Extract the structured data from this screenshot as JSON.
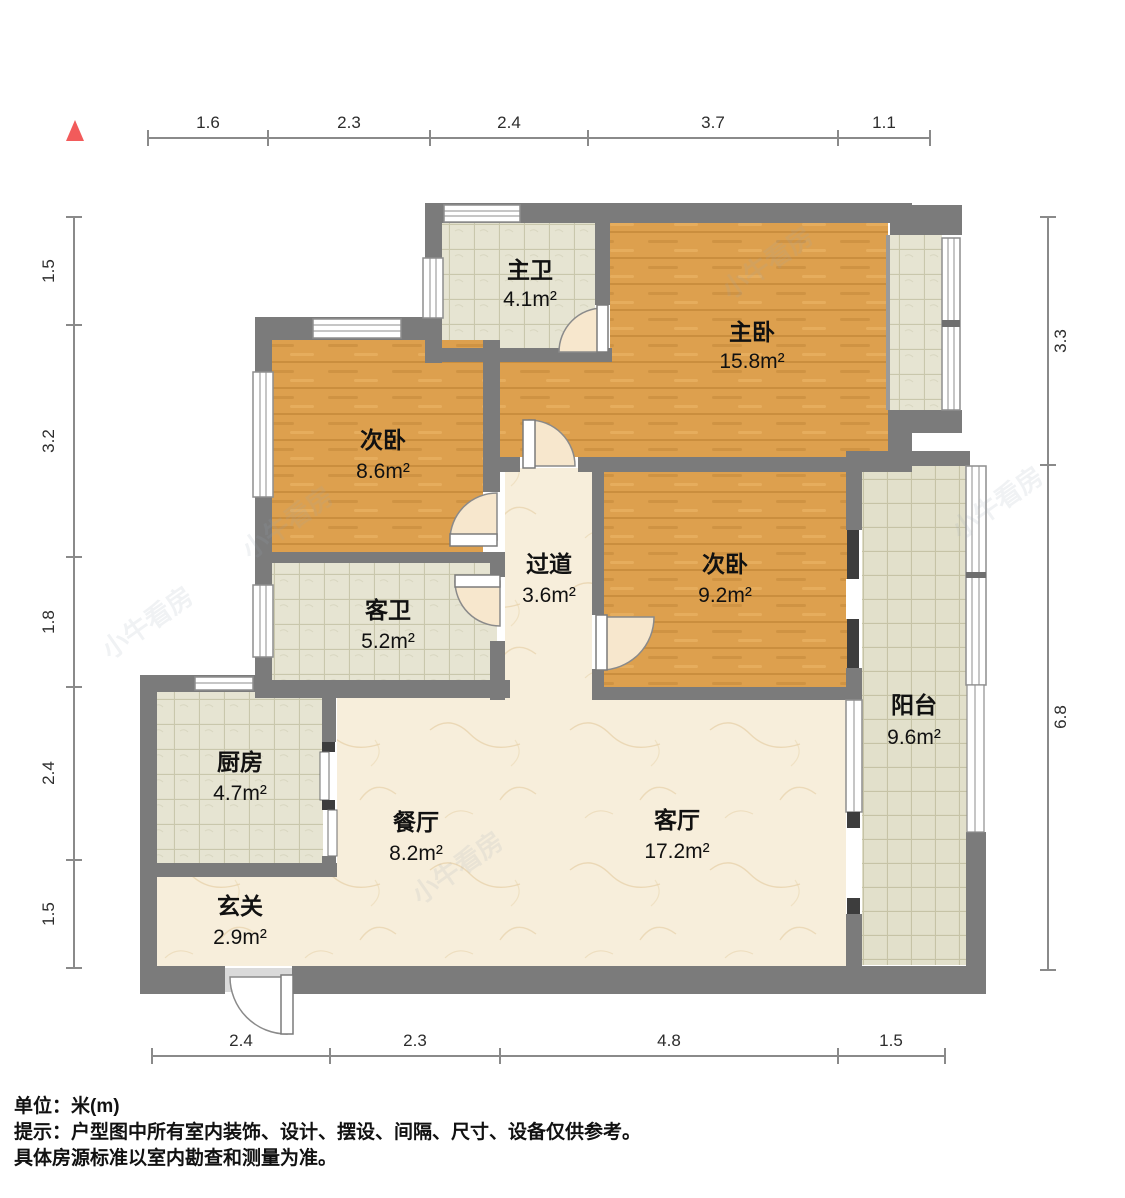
{
  "meta": {
    "type": "floor-plan",
    "watermark": "小牛看房"
  },
  "compass": {
    "shape": "triangle",
    "color": "#f25b5b",
    "meaning": "north-indicator"
  },
  "colors": {
    "wall": "#7b7b7b",
    "wood_floor": "#dda04e",
    "tile_floor": "#e6e4d2",
    "marble_floor": "#f7eedb",
    "balcony_tile": "#e2e0cb",
    "accent_red": "#f25b5b",
    "dark_door": "#3d3d3d"
  },
  "rooms": [
    {
      "name": "主卫",
      "area": "4.1m²"
    },
    {
      "name": "主卧",
      "area": "15.8m²"
    },
    {
      "name": "次卧",
      "area": "8.6m²"
    },
    {
      "name": "客卫",
      "area": "5.2m²"
    },
    {
      "name": "过道",
      "area": "3.6m²"
    },
    {
      "name": "次卧",
      "area": "9.2m²"
    },
    {
      "name": "阳台",
      "area": "9.6m²"
    },
    {
      "name": "厨房",
      "area": "4.7m²"
    },
    {
      "name": "餐厅",
      "area": "8.2m²"
    },
    {
      "name": "客厅",
      "area": "17.2m²"
    },
    {
      "name": "玄关",
      "area": "2.9m²"
    }
  ],
  "rulers": {
    "top": {
      "labels": [
        "1.6",
        "2.3",
        "2.4",
        "3.7",
        "1.1"
      ]
    },
    "bottom": {
      "labels": [
        "2.4",
        "2.3",
        "4.8",
        "1.5"
      ]
    },
    "left": {
      "labels": [
        "1.5",
        "3.2",
        "1.8",
        "2.4",
        "1.5"
      ]
    },
    "right": {
      "labels": [
        "3.3",
        "6.8"
      ]
    }
  },
  "notes": {
    "unit": "单位：米(m)",
    "tip_line1": "提示：户型图中所有室内装饰、设计、摆设、间隔、尺寸、设备仅供参考。",
    "tip_line2": "具体房源标准以室内勘查和测量为准。"
  }
}
